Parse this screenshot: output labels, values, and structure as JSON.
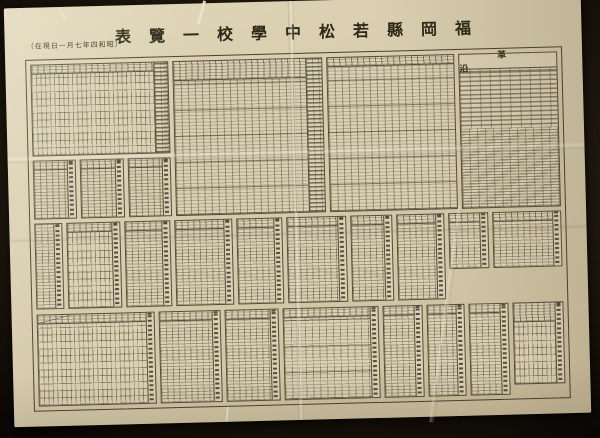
{
  "palette": {
    "backdrop": "#150f09",
    "backdrop_light": "#342a1b",
    "paper": "#d8cdae",
    "paper_shadow": "#c6ba99",
    "table_rule": "#554c3a",
    "ink": "#35301f"
  },
  "header": {
    "title_display": "表覽一校學中松若縣岡福",
    "title_reading": "福岡縣若松中學校一覽表",
    "date_note_display": "（在現日一月七年四和昭）",
    "date_note_reading": "昭和四年七月一日現在"
  },
  "sections": {
    "history_label_display": "革沿",
    "history_label_reading": "沿革"
  }
}
